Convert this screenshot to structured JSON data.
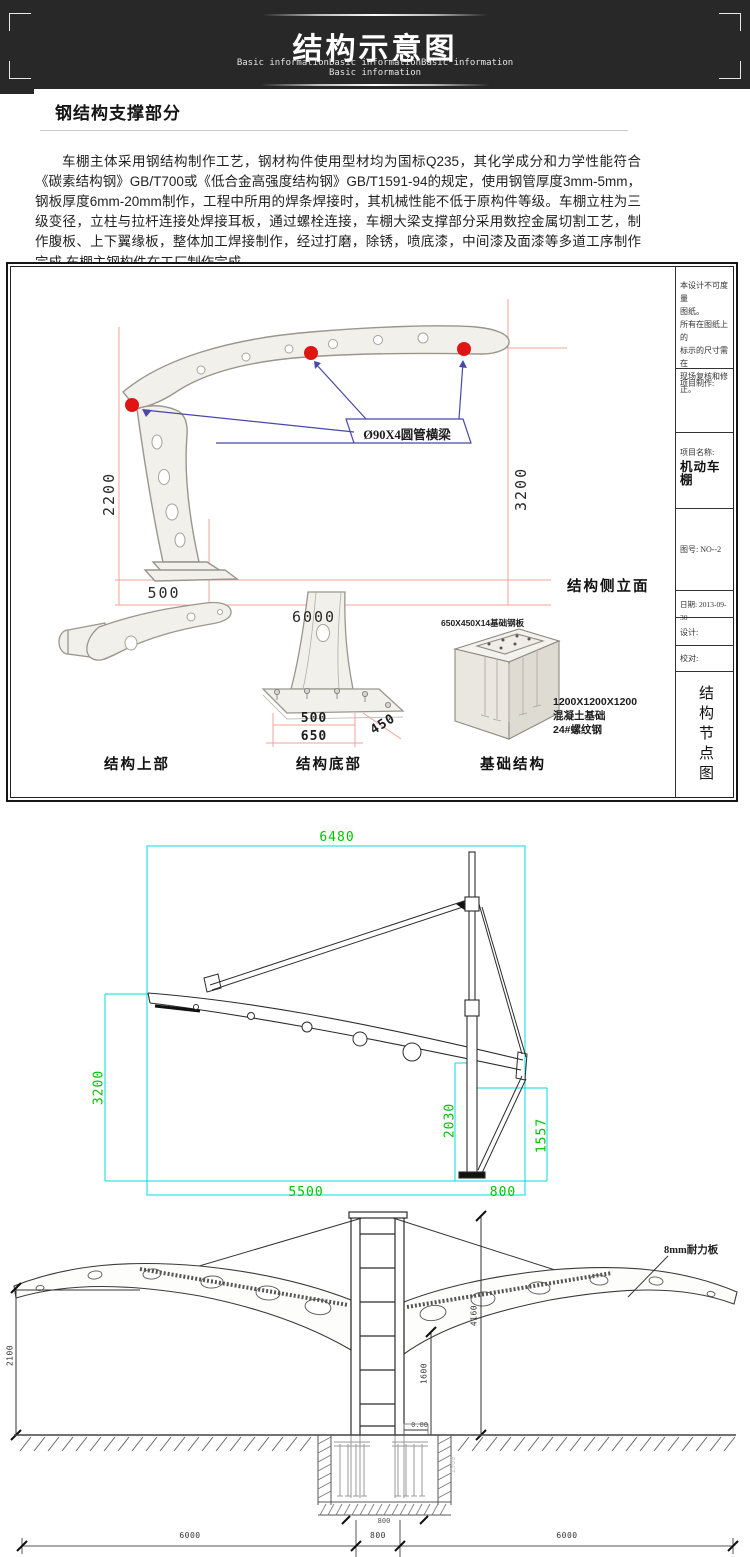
{
  "header": {
    "title": "结构示意图",
    "sub1": "Basic informationBasic informationBasic information",
    "sub2": "Basic information"
  },
  "section": {
    "heading": "钢结构支撑部分",
    "paragraph": "车棚主体采用钢结构制作工艺，钢材构件使用型材均为国标Q235，其化学成分和力学性能符合《碳素结构钢》GB/T700或《低合金高强度结构钢》GB/T1591-94的规定，使用钢管厚度3mm-5mm，钢板厚度6mm-20mm制作，工程中所用的焊条焊接时，其机械性能不低于原构件等级。车棚立柱为三级变径，立柱与拉杆连接处焊接耳板，通过螺栓连接，车棚大梁支撑部分采用数控金属切割工艺，制作腹板、上下翼缘板，整体加工焊接制作，经过打磨，除锈，喷底漆，中间漆及面漆等多道工序制作完成.车棚主钢构件在工厂制作完成。"
  },
  "p1": {
    "d2200": "2200",
    "d3200": "3200",
    "d500": "500",
    "d6000": "6000",
    "callout": "Ø90X4圆管横梁",
    "view": "结构侧立面",
    "lbl_upper": "结构上部",
    "lbl_bottom": "结构底部",
    "lbl_found": "基础结构",
    "b500": "500",
    "b650": "650",
    "b450": "450",
    "plate_note": "650X450X14基础钢板",
    "conc1": "1200X1200X1200",
    "conc2": "混凝土基础",
    "conc3": "24#螺纹钢",
    "tb": {
      "n1": "本设计不可度量",
      "n2": "图纸。",
      "n3": "所有在图纸上的",
      "n4": "标示的尺寸需在",
      "n5": "现场复核和修正。",
      "maker": "项目制作:",
      "name_label": "项目名称:",
      "name": "机动车棚",
      "no": "图号: NO--2",
      "date": "日期: 2013-09-30",
      "design": "设计:",
      "check": "校对:",
      "sheet": "结构节点图"
    }
  },
  "d2": {
    "top": "6480",
    "left": "3200",
    "pole": "2030",
    "right": "1557",
    "b1": "5500",
    "b2": "800"
  },
  "d3": {
    "panel": "8mm耐力板",
    "left": "2100",
    "total": "4160",
    "inner": "1600",
    "level": "0.00",
    "pit_depth": "1500",
    "pit_w": "800",
    "s1": "6000",
    "s2": "800",
    "s3": "6000"
  }
}
